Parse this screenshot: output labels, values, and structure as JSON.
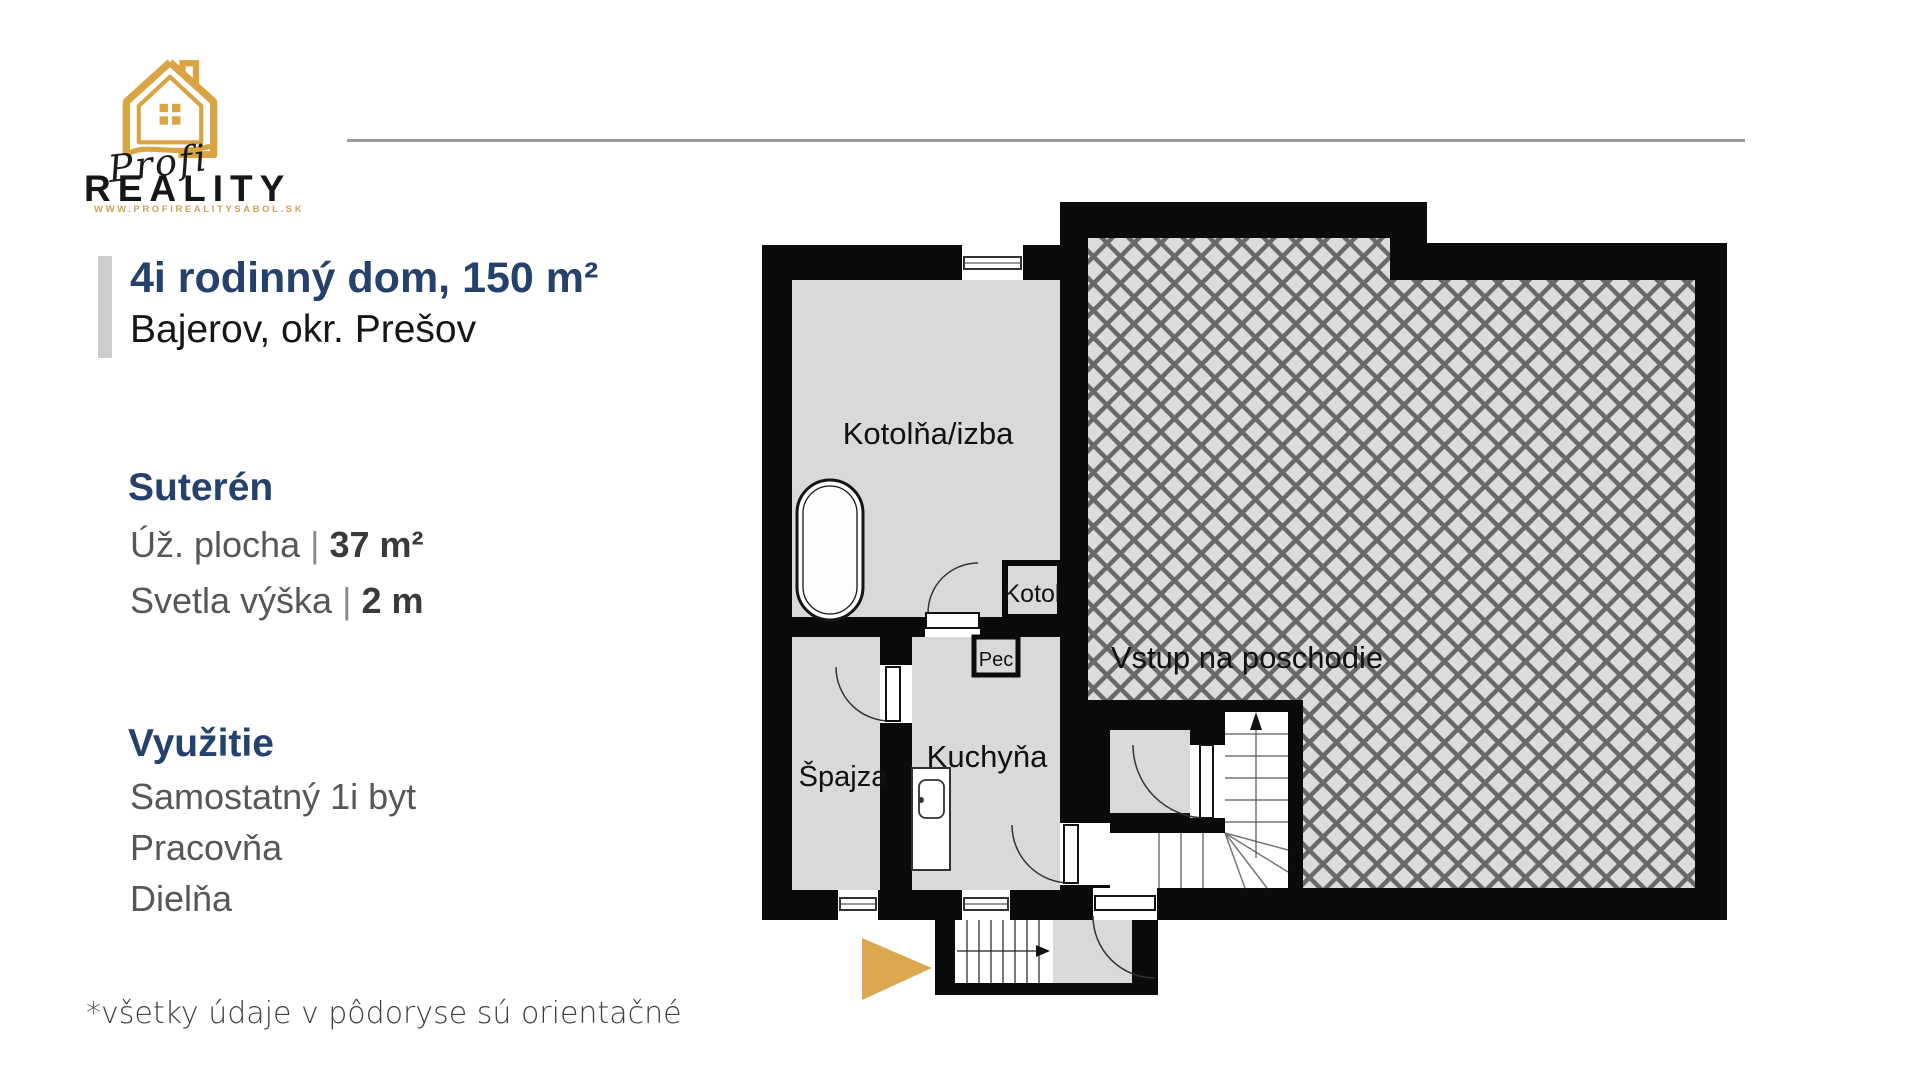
{
  "logo": {
    "brand_script": "Profi",
    "brand_name": "REALITY",
    "website": "WWW.PROFIREALITYSABOL.SK",
    "gold": "#d9a441"
  },
  "header": {
    "title": "4i rodinný dom, 150 m²",
    "subtitle": "Bajerov, okr. Prešov",
    "accent_color": "#24426b"
  },
  "sections": {
    "floor": {
      "heading": "Suterén",
      "rows": [
        {
          "label": "Úž. plocha",
          "separator": "|",
          "value": "37 m²"
        },
        {
          "label": "Svetla výška",
          "separator": "|",
          "value": "2 m"
        }
      ]
    },
    "usage": {
      "heading": "Využitie",
      "items": [
        "Samostatný 1i byt",
        "Pracovňa",
        "Dielňa"
      ]
    }
  },
  "footnote": "*všetky údaje v pôdoryse sú orientačné",
  "floorplan": {
    "labels": {
      "kotolna": "Kotolňa/izba",
      "vstup": "Vstup na poschodie",
      "spajza": "Špajza",
      "kuchyna": "Kuchyňa",
      "kotol": "Kotol",
      "pec": "Pec"
    },
    "colors": {
      "wall": "#0b0b0b",
      "room_fill": "#d9d9d9",
      "hatch_bg": "#dcdcdc",
      "hatch_line": "#696969",
      "arrow_gold": "#dca84e"
    }
  }
}
